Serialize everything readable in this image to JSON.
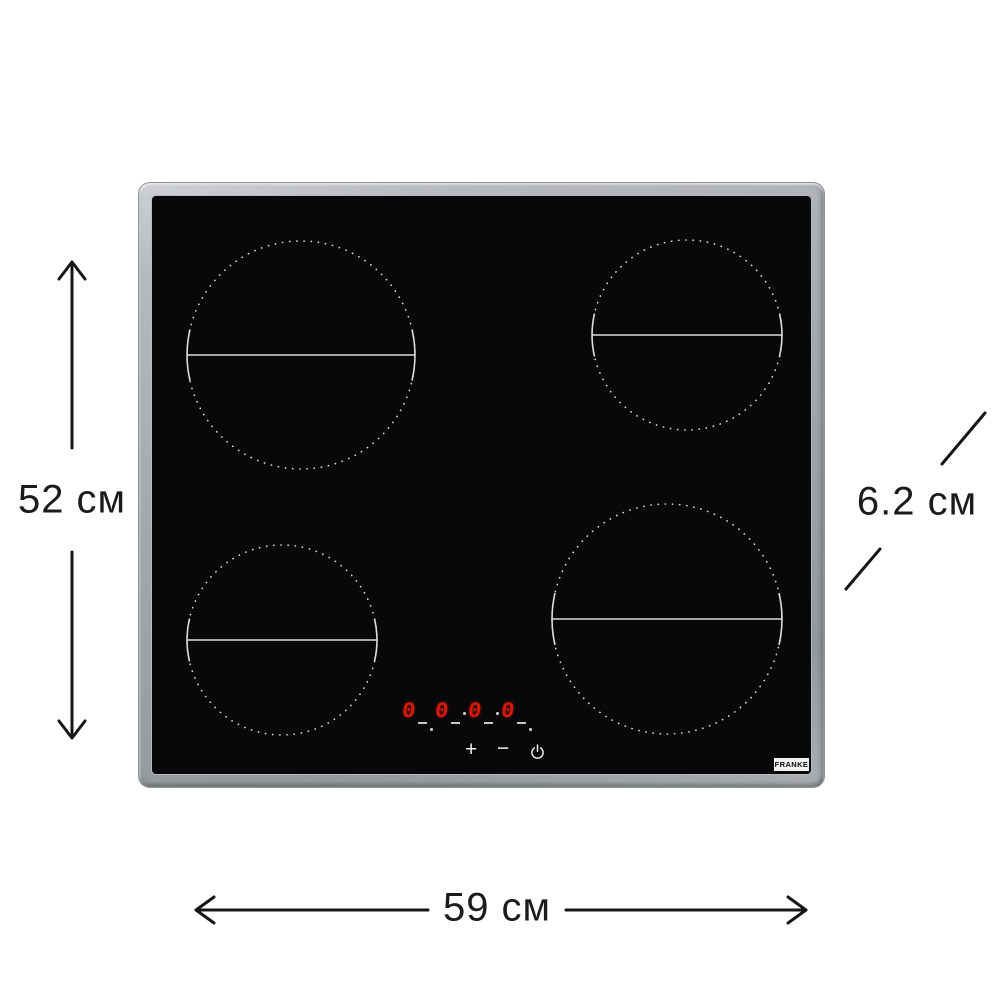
{
  "dimensions": {
    "height_label": "52 см",
    "width_label": "59 см",
    "depth_label": "6.2 см"
  },
  "hob": {
    "brand_logo": "FRANKE",
    "burners": [
      {
        "position": "top-left",
        "size": "large"
      },
      {
        "position": "top-right",
        "size": "medium"
      },
      {
        "position": "bottom-left",
        "size": "medium"
      },
      {
        "position": "bottom-right",
        "size": "large"
      }
    ],
    "control_panel": {
      "display_digits": [
        "0",
        "0",
        "0",
        "0"
      ],
      "plus_symbol": "+",
      "minus_symbol": "−",
      "power_icon": "power-standby-symbol"
    }
  },
  "colors": {
    "frame_silver": "#a8acaf",
    "glass_black": "#08080a",
    "display_red": "#d6180a",
    "burner_marking": "#dcdcdc",
    "annotation": "#1b1b1b",
    "background": "#ffffff"
  }
}
